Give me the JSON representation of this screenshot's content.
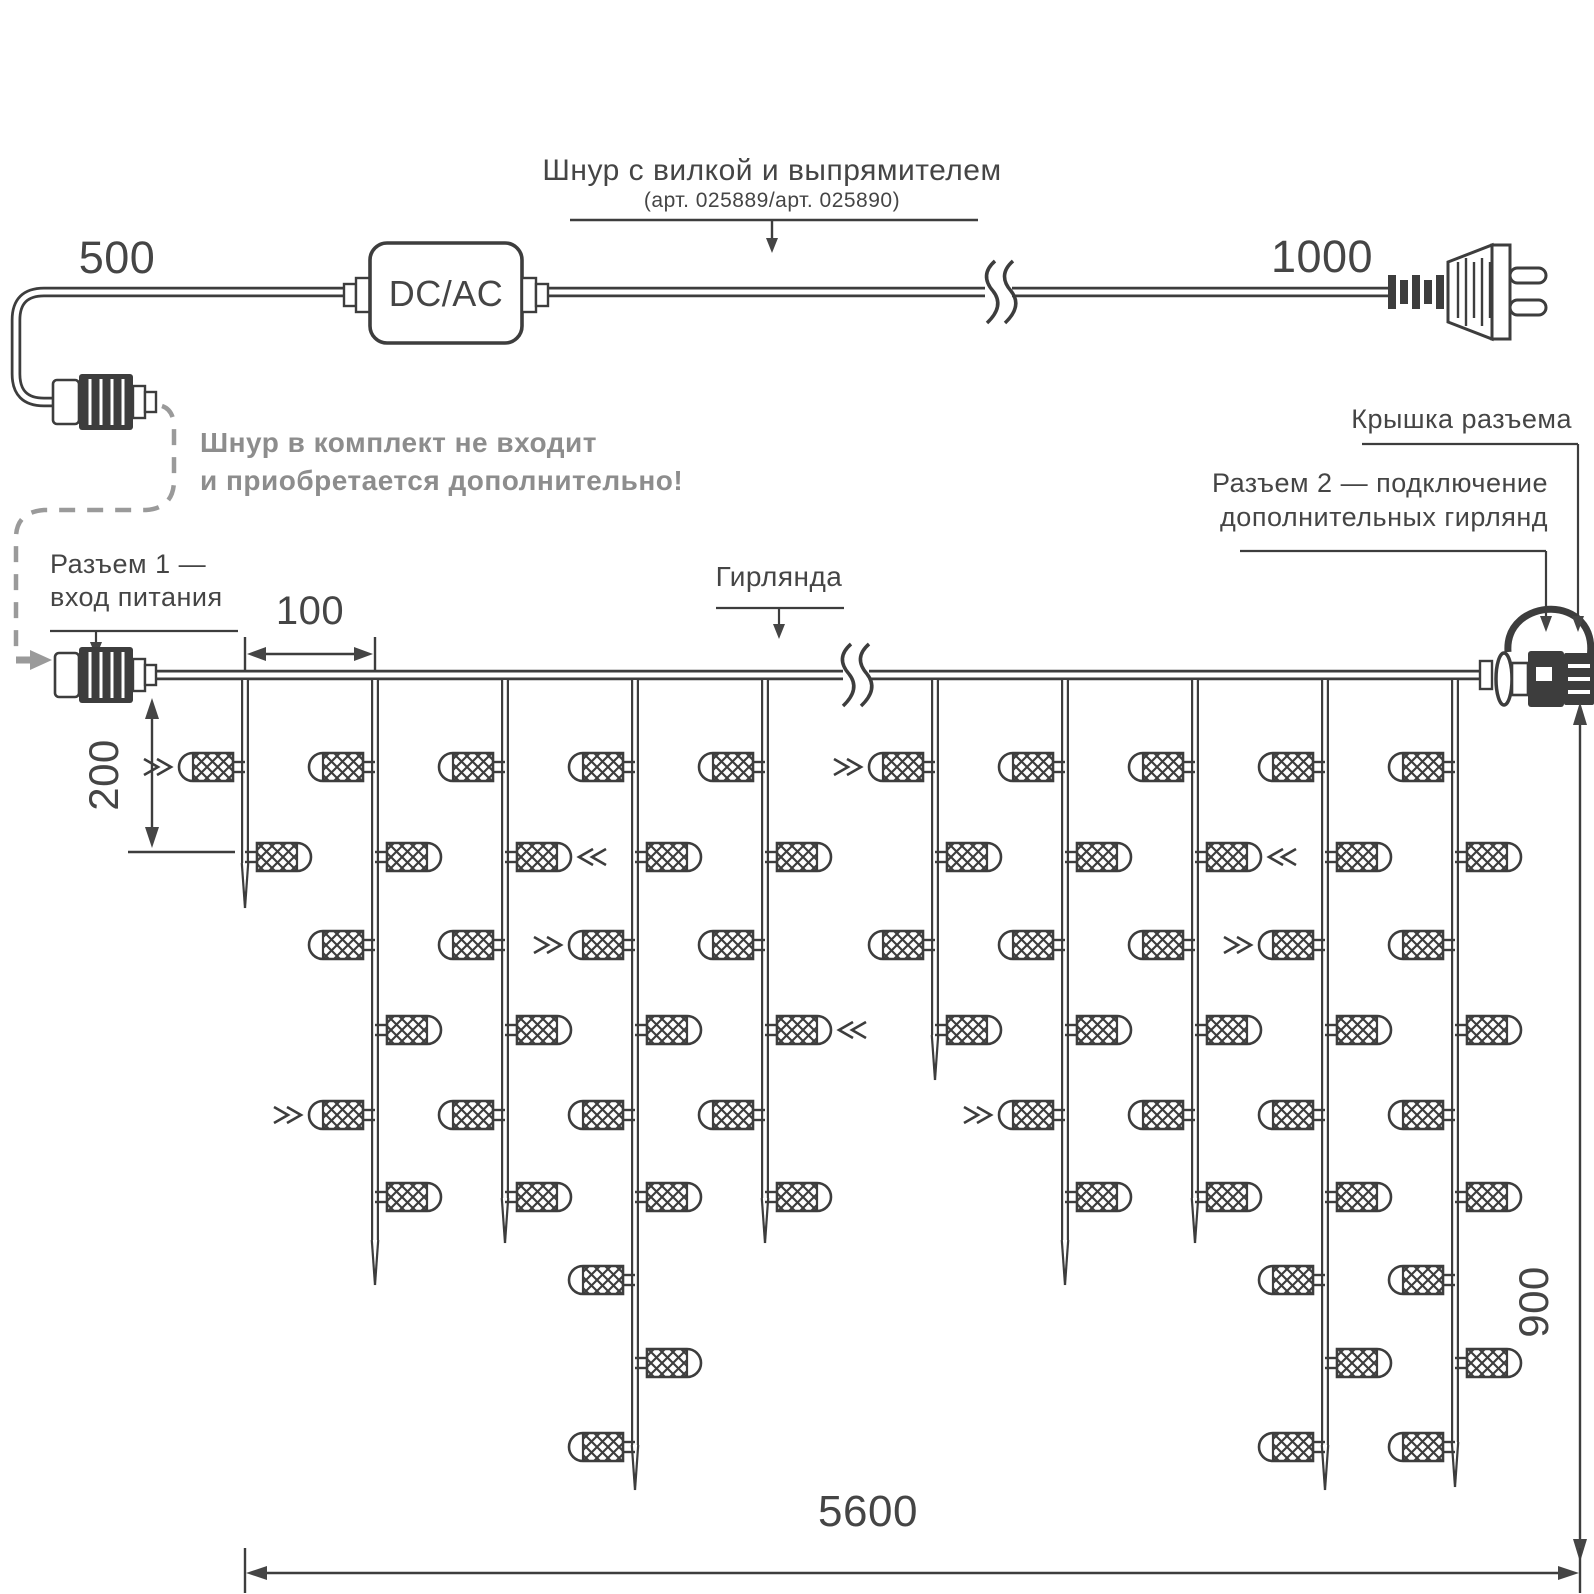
{
  "colors": {
    "line": "#3d3d3d",
    "text": "#454545",
    "gray": "#8d8d8d",
    "dashed": "#9a9a9a",
    "bg": "#ffffff"
  },
  "cord": {
    "dim_left": "500",
    "dim_right": "1000",
    "converter": "DC/AC",
    "title": "Шнур с вилкой и выпрямителем",
    "subtitle": "(арт. 025889/арт. 025890)",
    "note1": "Шнур в комплект не входит",
    "note2": "и приобретается дополнительно!"
  },
  "labels": {
    "conn1_l1": "Разъем 1 —",
    "conn1_l2": "вход питания",
    "garland": "Гирлянда",
    "cap": "Крышка разъема",
    "conn2_l1": "Разъем 2 — подключение",
    "conn2_l2": "дополнительных гирлянд"
  },
  "dims": {
    "spacing": "100",
    "drop": "200",
    "height": "900",
    "total": "5600"
  },
  "garland": {
    "cable_y": 675,
    "rows": [
      767,
      857,
      945,
      1030,
      1115,
      1197,
      1280,
      1363,
      1447
    ],
    "break_x": 855,
    "drops": [
      {
        "x": 245,
        "bulbs": 2,
        "tip": 908
      },
      {
        "x": 375,
        "bulbs": 6,
        "tip": 1285
      },
      {
        "x": 505,
        "bulbs": 6,
        "tip": 1243
      },
      {
        "x": 635,
        "bulbs": 9,
        "tip": 1490
      },
      {
        "x": 765,
        "bulbs": 6,
        "tip": 1243
      },
      {
        "x": 935,
        "bulbs": 4,
        "tip": 1080
      },
      {
        "x": 1065,
        "bulbs": 6,
        "tip": 1285
      },
      {
        "x": 1195,
        "bulbs": 6,
        "tip": 1243
      },
      {
        "x": 1325,
        "bulbs": 9,
        "tip": 1490
      },
      {
        "x": 1455,
        "bulbs": 9,
        "tip": 1487
      }
    ],
    "markers": [
      {
        "drop": 0,
        "row": 0
      },
      {
        "drop": 1,
        "row": 4
      },
      {
        "drop": 2,
        "row": 1
      },
      {
        "drop": 3,
        "row": 2
      },
      {
        "drop": 4,
        "row": 3
      },
      {
        "drop": 5,
        "row": 0
      },
      {
        "drop": 6,
        "row": 4
      },
      {
        "drop": 7,
        "row": 1
      },
      {
        "drop": 8,
        "row": 2
      }
    ]
  }
}
